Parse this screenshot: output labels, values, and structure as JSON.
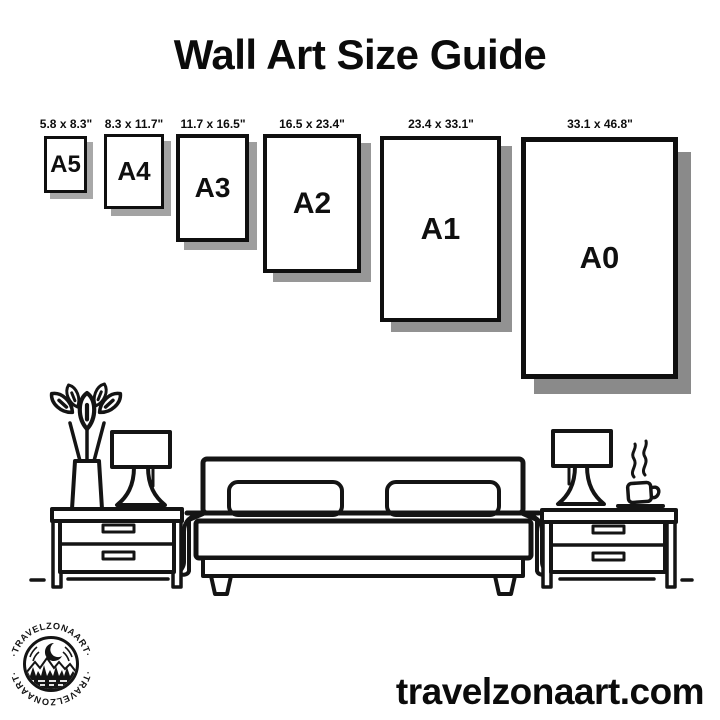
{
  "page": {
    "title": "Wall Art Size Guide",
    "background": "#ffffff"
  },
  "sizes": [
    {
      "label": "A5",
      "dimensions": "5.8 x 8.3\""
    },
    {
      "label": "A4",
      "dimensions": "8.3 x 11.7\""
    },
    {
      "label": "A3",
      "dimensions": "11.7 x 16.5\""
    },
    {
      "label": "A2",
      "dimensions": "16.5 x 23.4\""
    },
    {
      "label": "A1",
      "dimensions": "23.4 x 33.1\""
    },
    {
      "label": "A0",
      "dimensions": "33.1 x 46.8\""
    }
  ],
  "brand": {
    "arc_text_top": "·TRAVELZONAART·",
    "arc_text_bottom": "·TRAVELZONAART·",
    "website": "travelzonaart.com"
  },
  "colors": {
    "ink": "#141414",
    "paper": "#ffffff",
    "shadow": "#979797"
  },
  "illustration": {
    "name": "bedroom-line-art",
    "items": [
      "potted-plant",
      "table-lamp",
      "nightstand",
      "bed-with-pillows",
      "nightstand",
      "table-lamp",
      "coffee-cup"
    ]
  }
}
